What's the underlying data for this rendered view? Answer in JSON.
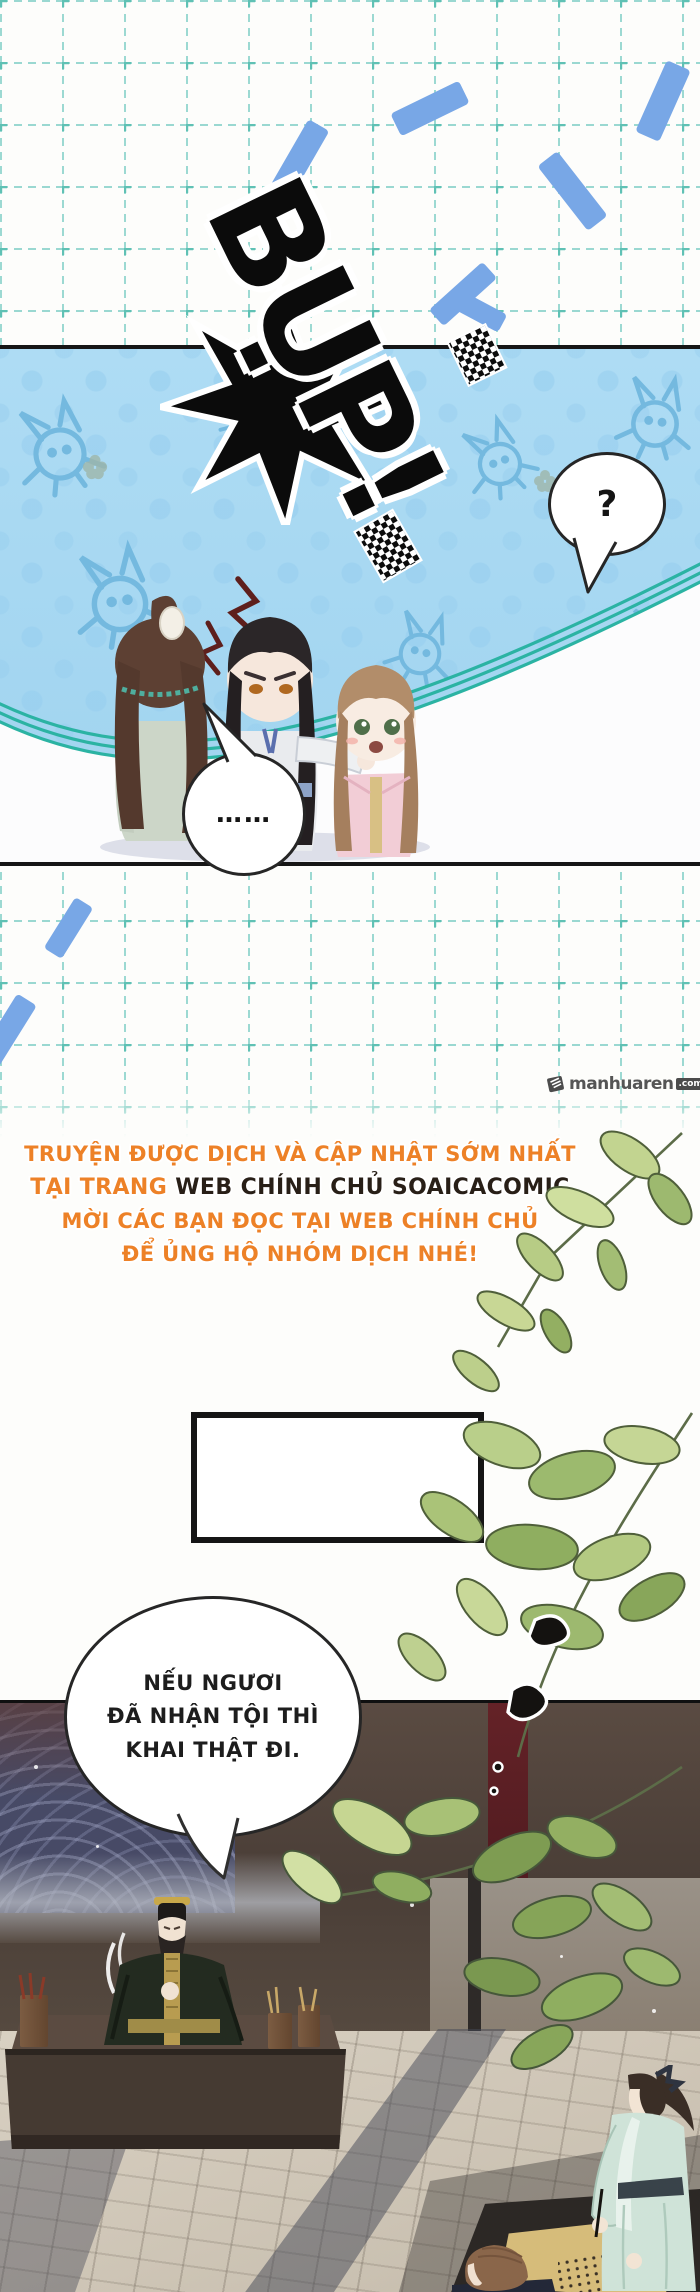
{
  "sfx": {
    "text": "BỤP!"
  },
  "panel": {
    "question_mark": "?",
    "ellipsis": "……"
  },
  "watermark": {
    "name": "manhuaren",
    "tld": ".com",
    "icon": "book-logo-icon"
  },
  "notice": {
    "line1": "TRUYỆN ĐƯỢC DỊCH VÀ CẬP NHẬT SỚM NHẤT",
    "line2_orange": "TẠI TRANG ",
    "line2_dark": "WEB CHÍNH CHỦ SOAICACOMIC",
    "line3": "MỜI CÁC BẠN ĐỌC TẠI WEB CHÍNH CHỦ",
    "line4": "ĐỂ ỦNG HỘ NHÓM DỊCH NHÉ!",
    "accent_color": "#ed8127",
    "dark_color": "#281f17"
  },
  "dialogue": {
    "line1": "NẾU NGƯƠI",
    "line2": "ĐÃ NHẬN TỘI THÌ",
    "line3": "KHAI THẬT ĐI."
  },
  "colors": {
    "panel_blue": "#aedcf4",
    "grid_teal": "#8bd3cb",
    "dash_blue": "#78a7e6",
    "arc_teal": "#2bb3a3",
    "leaf_green": "#a9c178",
    "scene_wall": "#4a3e37",
    "stone_floor": "#cfc6b7",
    "sfx_black": "#0b0b0b"
  }
}
